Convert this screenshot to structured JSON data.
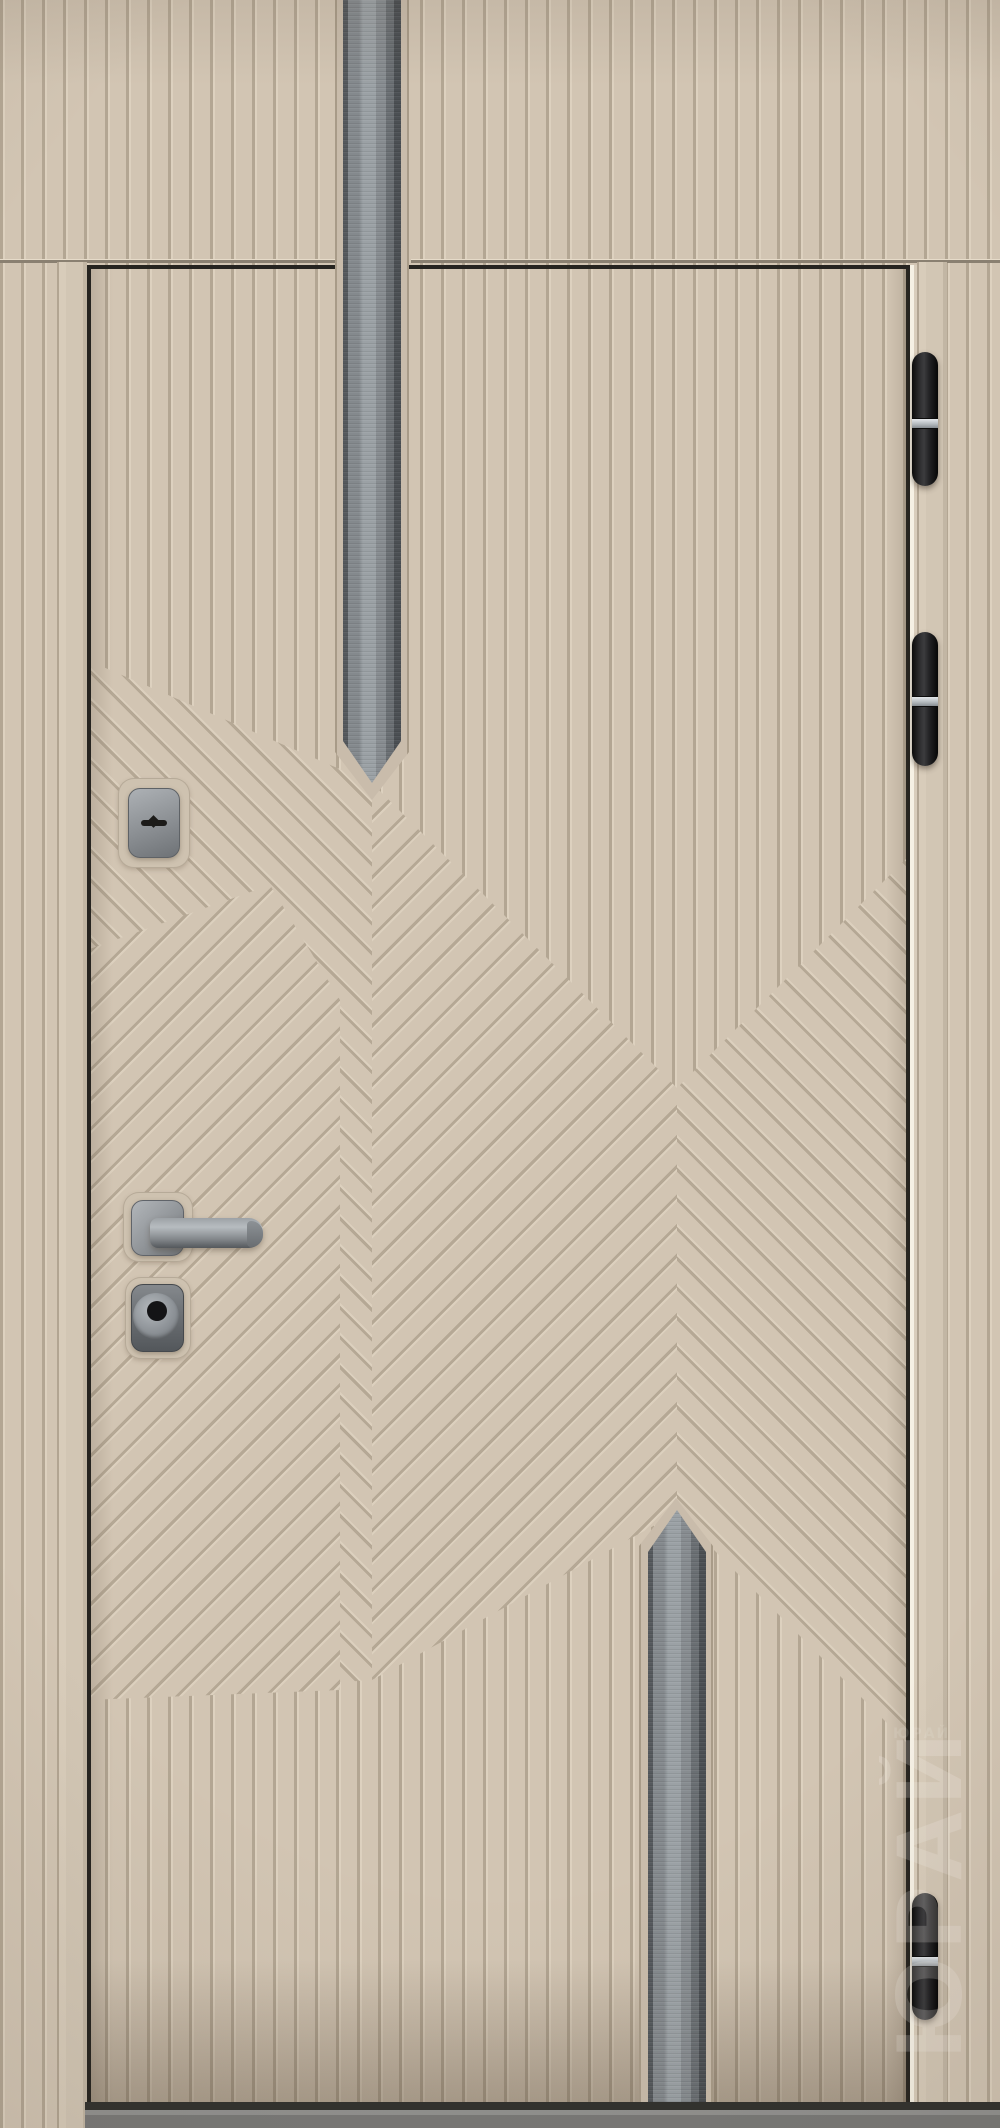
{
  "scene": {
    "type": "product-photo",
    "subject": "steel entry door with beige fluted chevron panel",
    "parts": [
      "transom-panel",
      "door-frame",
      "door-leaf",
      "metal-inlay-strip-top",
      "metal-inlay-strip-bottom",
      "keyhole-escutcheon",
      "lever-handle",
      "cylinder-escutcheon",
      "hinge-top",
      "hinge-middle",
      "hinge-bottom",
      "threshold"
    ],
    "hinge_count": 3
  },
  "watermark": {
    "brand_vertical": "ЮРАЙ",
    "brand_small": "ЮРАЙ"
  },
  "colors": {
    "panel_base": "#d2c5b3",
    "flute_groove": "#b3a693",
    "flute_highlight": "#ddd1bf",
    "leaf_outline": "#262420",
    "metal_strip": "#9ba1a5",
    "hinge_black": "#1d1d1f",
    "hinge_band": "#b5bbbf",
    "hardware_steel": "#909498",
    "gap_light": "#f6f1e4",
    "threshold_gray": "#7a7a78",
    "watermark_white": "rgba(250,247,241,0.20)"
  }
}
